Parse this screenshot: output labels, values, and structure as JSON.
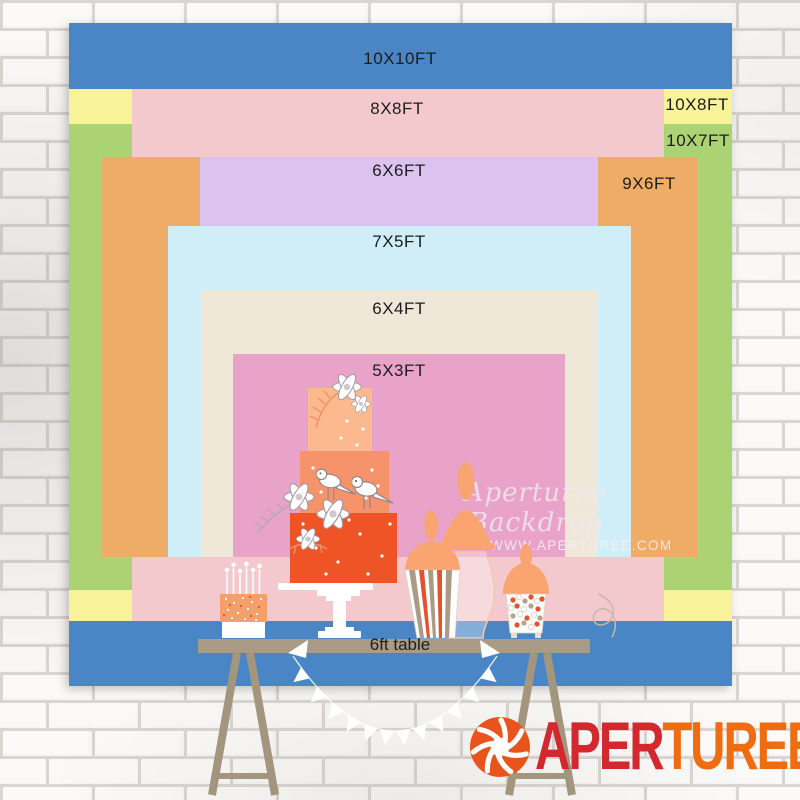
{
  "backdrop_chart": {
    "unit": "FT",
    "label_color": "#1c1c1c",
    "layers": [
      {
        "id": "10x10ft",
        "label": "10X10FT",
        "color": "#4a86c6",
        "x": 0,
        "y": 0,
        "w": 663,
        "h": 663,
        "lx": 331,
        "ly": 36
      },
      {
        "id": "10x8ft",
        "label": "10X8FT",
        "color": "#f8f298",
        "x": 0,
        "y": 66,
        "w": 663,
        "h": 532,
        "lx": 628,
        "ly": 82
      },
      {
        "id": "10x7ft",
        "label": "10X7FT",
        "color": "#abd374",
        "x": 0,
        "y": 101,
        "w": 663,
        "h": 466,
        "lx": 629,
        "ly": 118
      },
      {
        "id": "8x8ft",
        "label": "8X8FT",
        "color": "#f4c9cd",
        "x": 63,
        "y": 66,
        "w": 532,
        "h": 532,
        "lx": 328,
        "ly": 86
      },
      {
        "id": "9x6ft",
        "label": "9X6FT",
        "color": "#efac66",
        "x": 32,
        "y": 134,
        "w": 597,
        "h": 400,
        "lx": 580,
        "ly": 161
      },
      {
        "id": "6x6ft",
        "label": "6X6FT",
        "color": "#dcc2ee",
        "x": 131,
        "y": 134,
        "w": 398,
        "h": 400,
        "lx": 330,
        "ly": 148
      },
      {
        "id": "7x5ft",
        "label": "7X5FT",
        "color": "#cfeef8",
        "x": 99,
        "y": 203,
        "w": 463,
        "h": 331,
        "lx": 330,
        "ly": 219
      },
      {
        "id": "6x4ft",
        "label": "6X4FT",
        "color": "#efe7d8",
        "x": 132,
        "y": 267,
        "w": 397,
        "h": 267,
        "lx": 330,
        "ly": 286
      },
      {
        "id": "5x3ft",
        "label": "5X3FT",
        "color": "#e9a3c8",
        "x": 164,
        "y": 331,
        "w": 332,
        "h": 203,
        "lx": 330,
        "ly": 348
      }
    ]
  },
  "table": {
    "label": "6ft table",
    "top_color": "#a99b86",
    "leg_color": "#a3957e"
  },
  "watermark": {
    "line1": "Aperturee Backdrop",
    "line2": "WWW.APERTUREE.COM"
  },
  "logo": {
    "part1": "APER",
    "part2": "TUREE",
    "part1_color": "#d3282e",
    "part2_color": "#ef6c10",
    "icon": "aperture-icon",
    "icon_color": "#e8541c"
  },
  "illustration": {
    "cake_tier_top_color": "#fbb98d",
    "cake_tier_middle_color": "#f7936b",
    "cake_tier_bottom_color": "#ee5426",
    "jar_lid_color": "#f9a471",
    "candy_red": "#e2532f",
    "garland_color": "#ffffff"
  },
  "wall": {
    "brick_color": "#f7f6f4",
    "mortar_color": "#d9d5d0"
  }
}
